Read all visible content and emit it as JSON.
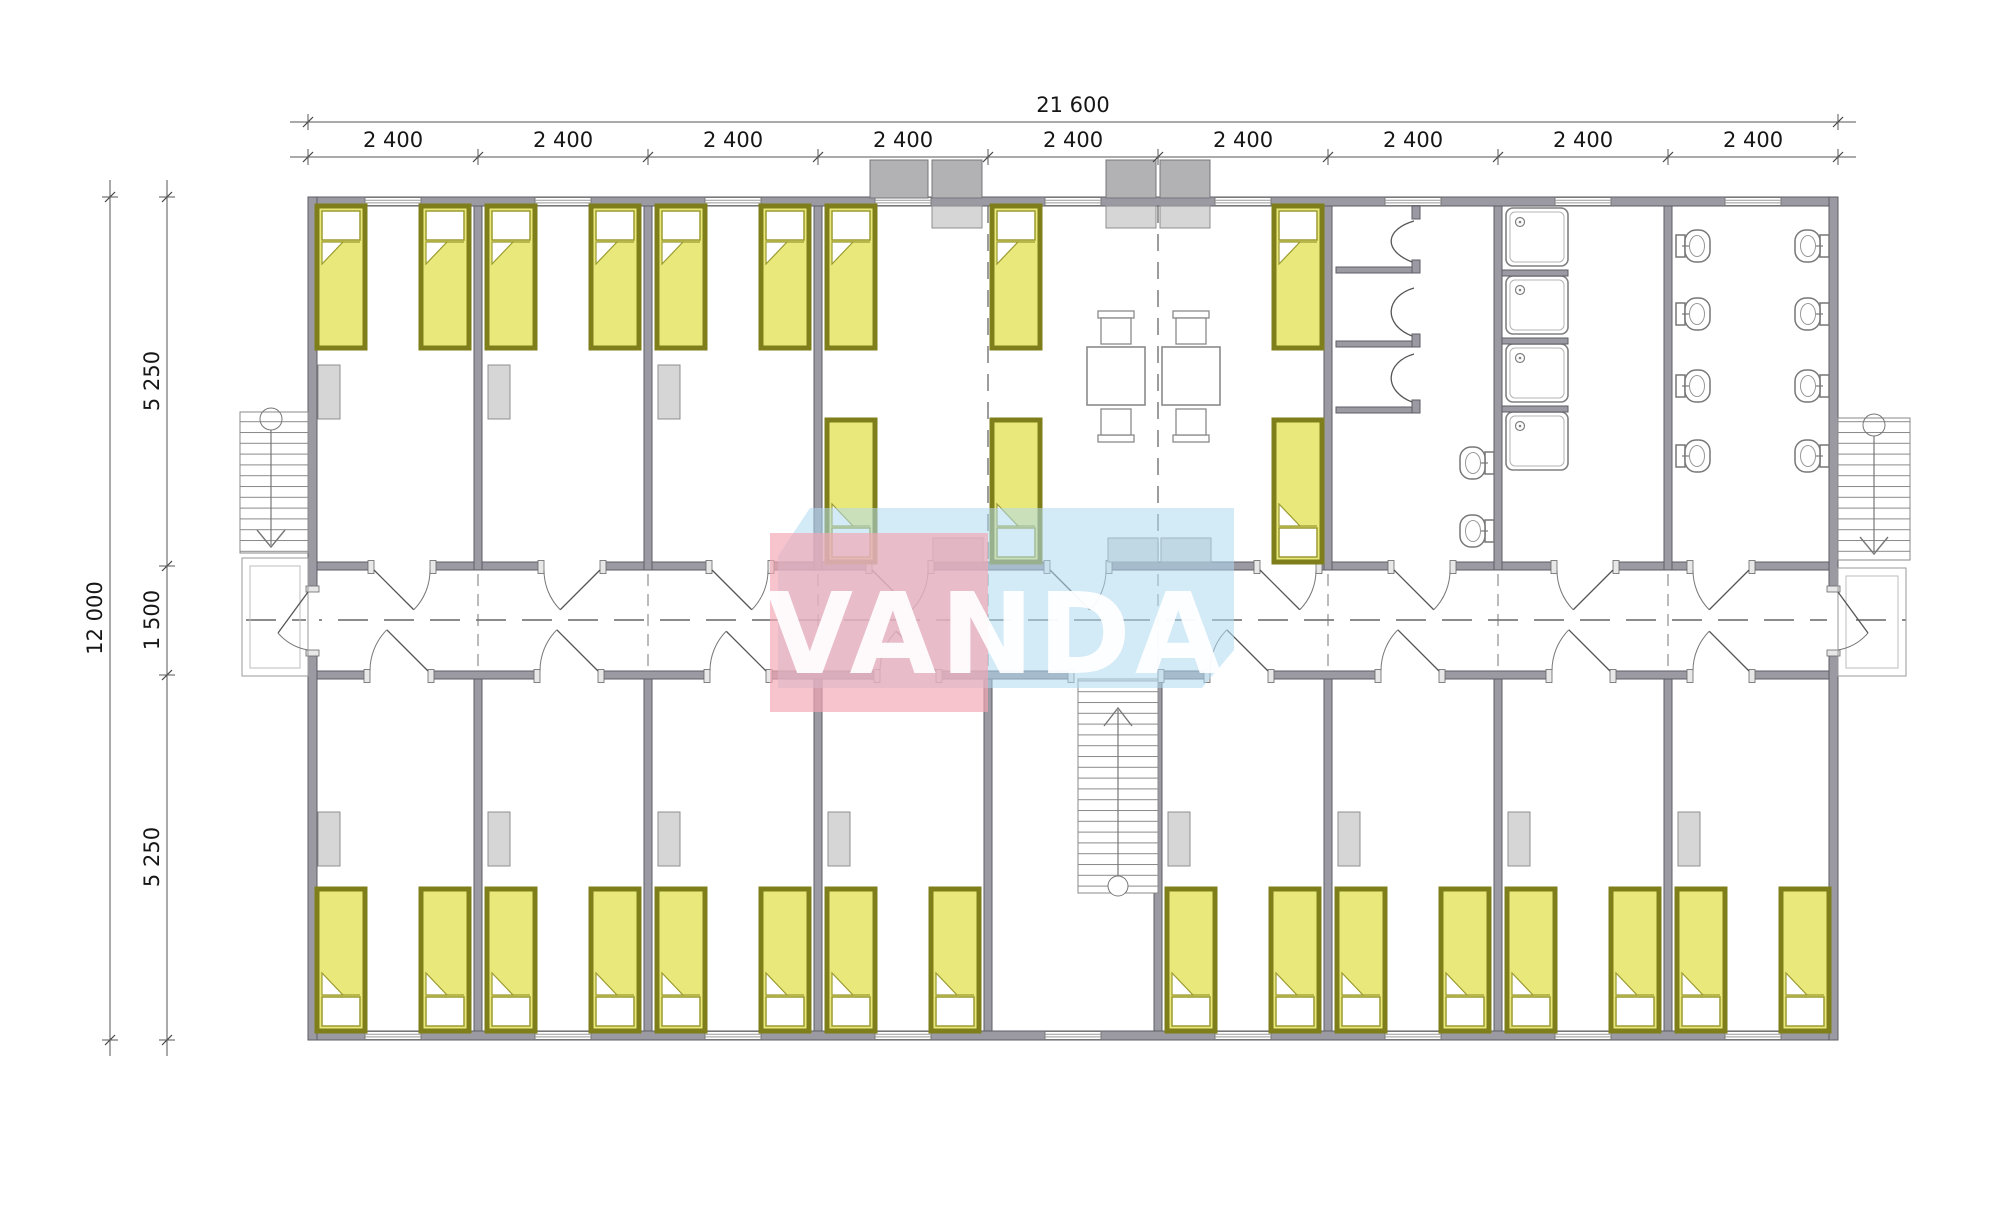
{
  "drawing": {
    "type": "architectural floor plan",
    "description": "Dormitory barracks floor plan with bedrooms, common area, showers, toilets and three staircases"
  },
  "dimensions": {
    "overall_width": "21 600",
    "bays": [
      "2 400",
      "2 400",
      "2 400",
      "2 400",
      "2 400",
      "2 400",
      "2 400",
      "2 400",
      "2 400"
    ],
    "overall_height": "12 000",
    "height_segments": [
      "5 250",
      "1 500",
      "5 250"
    ]
  },
  "watermark": {
    "text": "VANDA",
    "pink": "#f3a7b4",
    "blue": "#afd8f0"
  },
  "inventory": {
    "beds": 28,
    "tables": 2,
    "chairs": 4,
    "shower_stalls": 3,
    "shower_trays": 4,
    "toilets": 10,
    "staircases": 3
  },
  "colors": {
    "wall": "#9b9aa3",
    "bed_fill": "#e9e97b",
    "bed_frame": "#7e7e1a",
    "furniture": "#d6d6d6"
  }
}
